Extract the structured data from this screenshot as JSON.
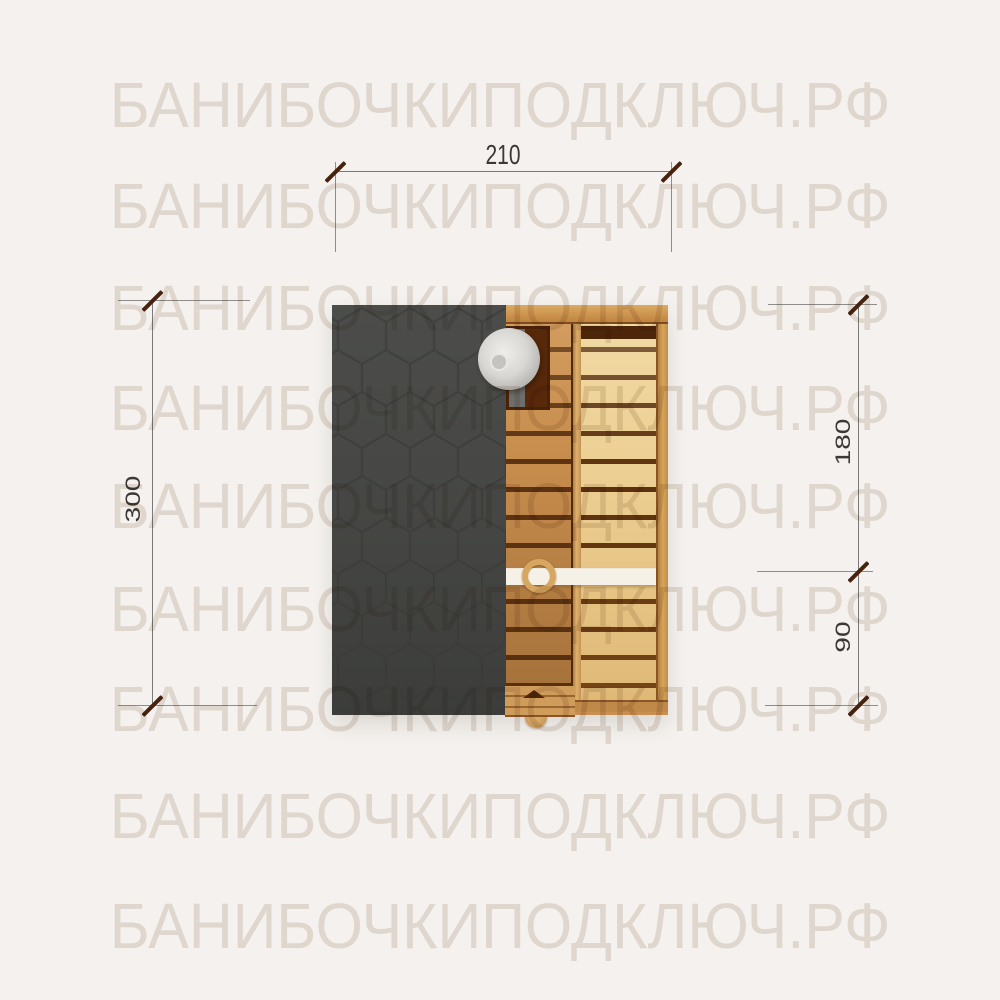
{
  "watermark": {
    "text": "БАНИБОЧКИПОДКЛЮЧ.РФ",
    "color": "#e6e0da"
  },
  "dimensions": {
    "overall_width": "210",
    "overall_length": "300",
    "steam_room_length": "180",
    "entry_room_length": "90"
  },
  "plan": {
    "description_elements": {
      "roof": "roof-shingles-hexagon-pattern",
      "stove": "stove-with-flue-pipe",
      "partition": "bench-partition-wall",
      "door": "entrance-door-with-knob"
    }
  },
  "colors": {
    "background": "#f4f1ee",
    "watermark": "#e6e0da",
    "roof": "#454643",
    "roof_pattern": "#393a38",
    "wood_warm": "#c78d4d",
    "wood_light": "#eccf92",
    "plank_gap": "#5e3312",
    "stove": "#58280a",
    "flue_metal": "#d9d7d3",
    "bench_wall": "#f6f1e7",
    "dimension_line": "#7b7977",
    "dimension_tick": "#47230f",
    "dimension_text": "#3c3834"
  }
}
